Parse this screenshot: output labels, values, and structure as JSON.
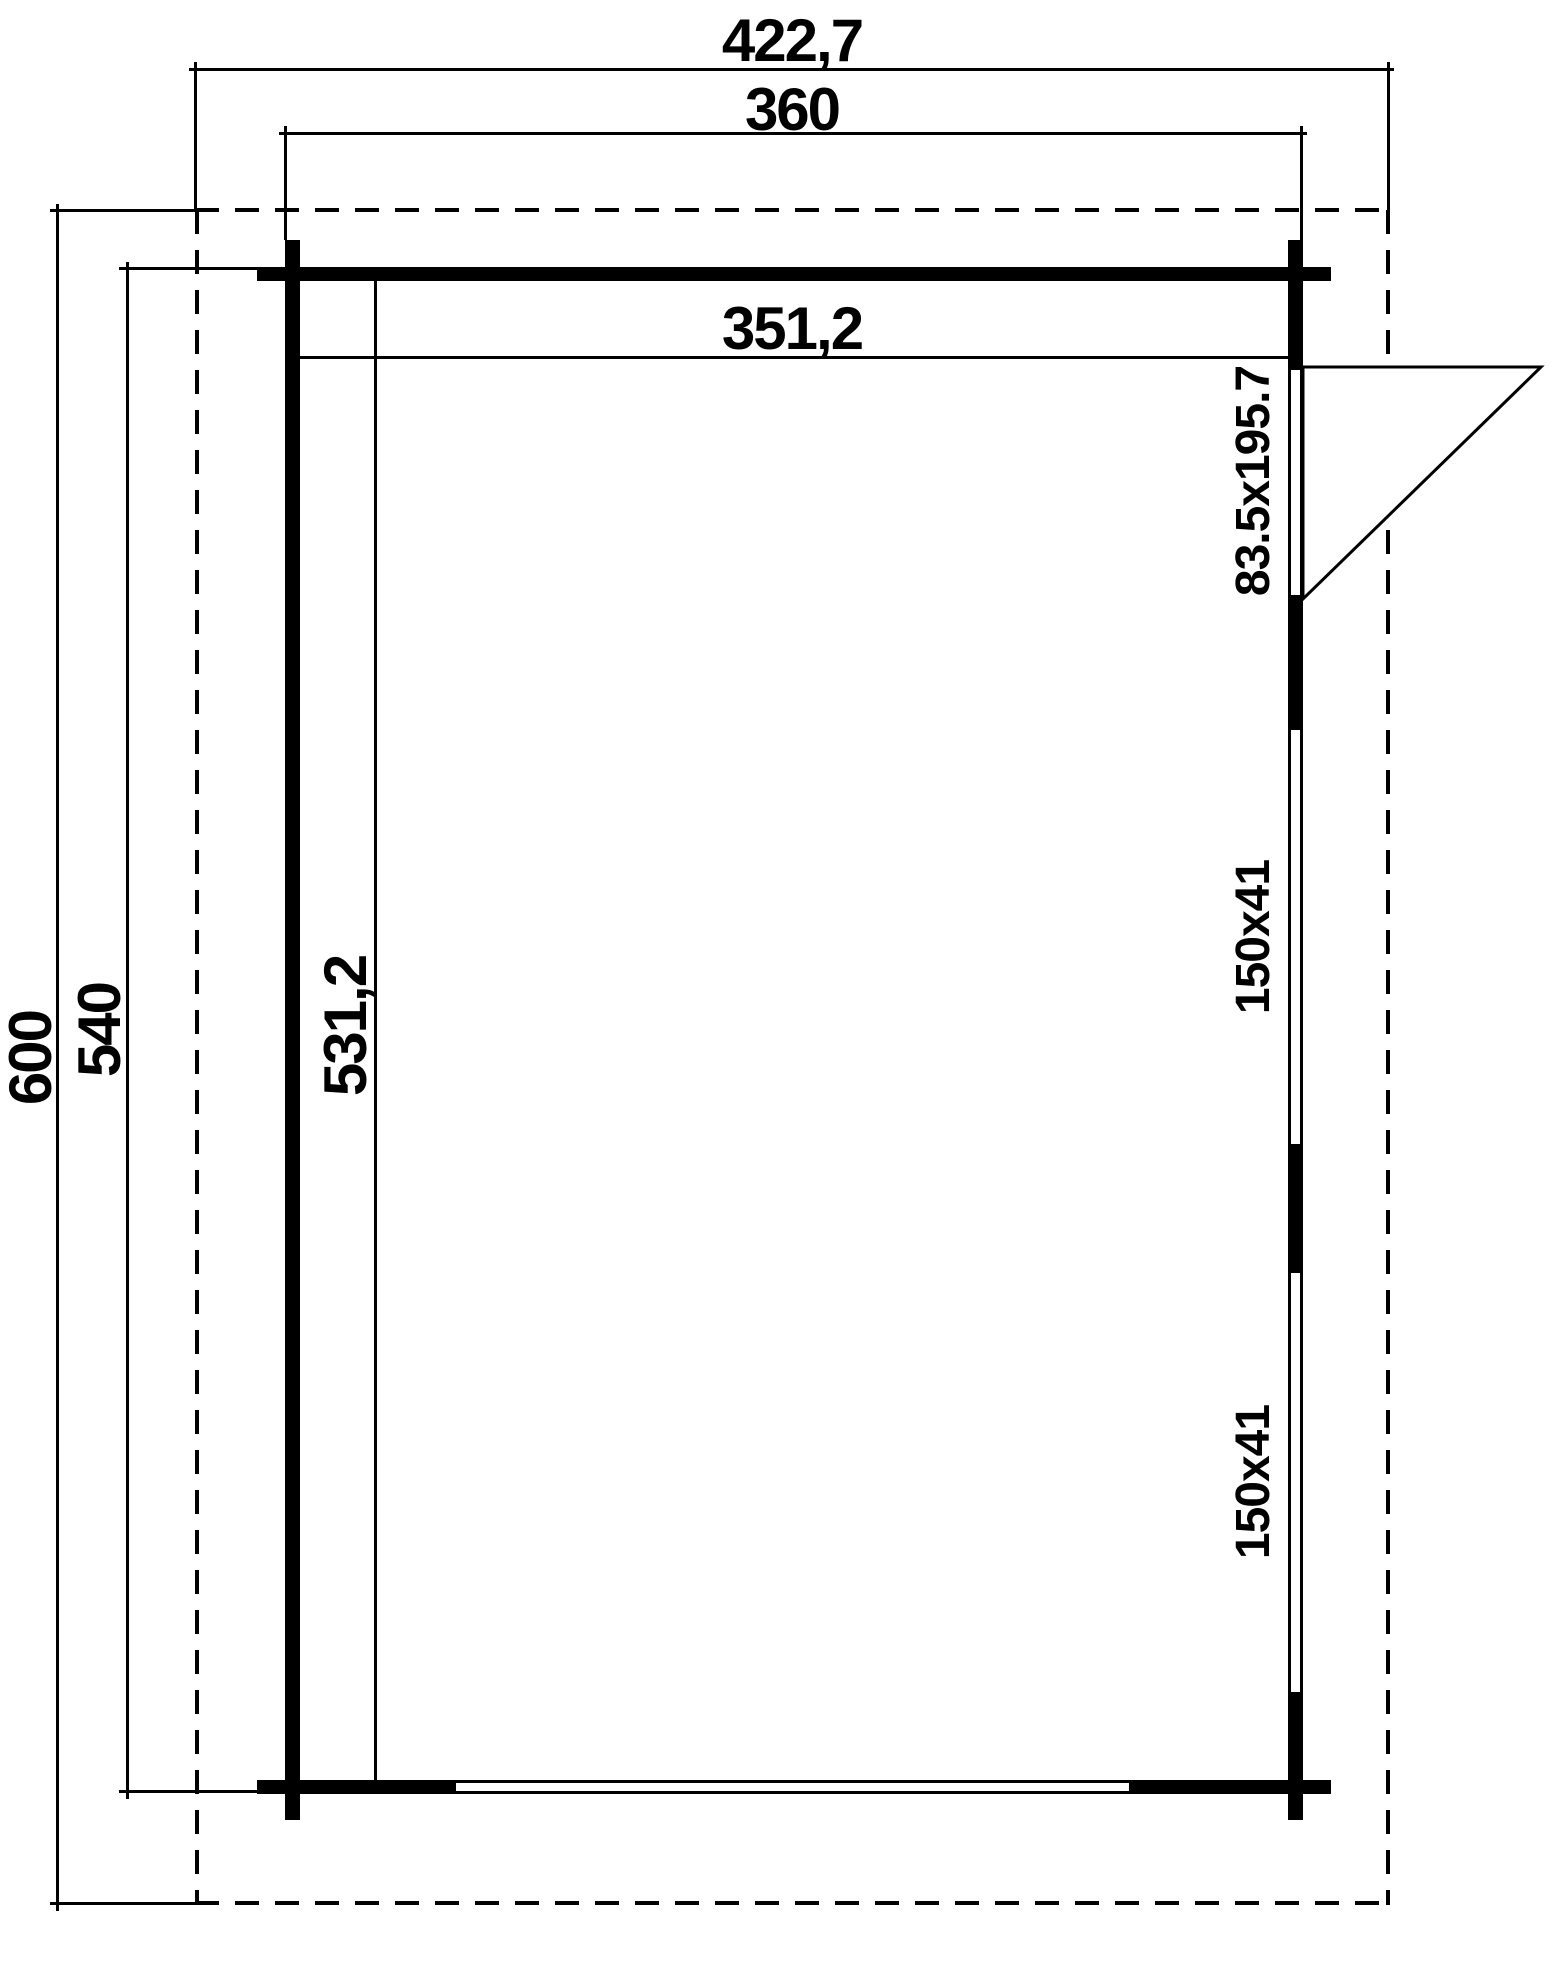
{
  "drawing": {
    "type": "floor-plan",
    "colors": {
      "line": "#000000",
      "background": "#ffffff"
    },
    "dimensions": {
      "roof_overall_width": "422,7",
      "wall_outer_width": "360",
      "inner_width": "351,2",
      "roof_overall_depth": "600",
      "wall_outer_depth": "540",
      "inner_depth": "531,2"
    },
    "openings": {
      "door_label": "83.5x195.7",
      "window_top_label": "150x41",
      "window_bottom_label": "150x41"
    }
  }
}
